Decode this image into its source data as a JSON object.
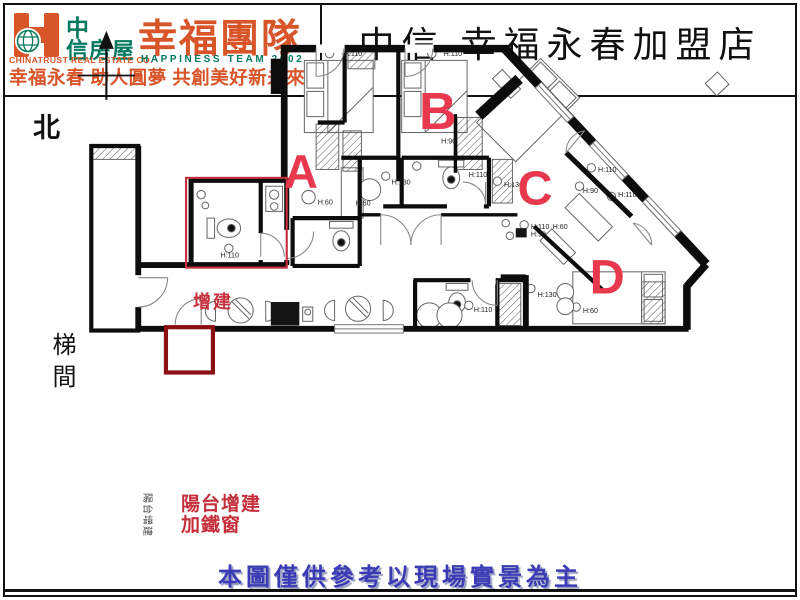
{
  "header": {
    "logo": {
      "cjk_top": "中",
      "cjk_bottom": "信房屋",
      "company_en": "CHINATRUST REAL ESTATE CO."
    },
    "team": {
      "zh": "幸福團隊",
      "en": "HAPPINESS TEAM 2002"
    },
    "tagline": "幸福永春 助人圓夢 共創美好新未來",
    "title": "中信 幸福永春加盟店"
  },
  "plan": {
    "north": "北",
    "stairwell": "梯間",
    "annotations": {
      "addition": "增建",
      "balcony_line1": "陽台增建",
      "balcony_line2": "加鐵窗",
      "balcony_box": "陽台增建"
    },
    "rooms": [
      {
        "label": "A"
      },
      {
        "label": "B"
      },
      {
        "label": "C"
      },
      {
        "label": "D"
      }
    ],
    "height_labels": [
      {
        "text": "H:110"
      },
      {
        "text": "H:110"
      },
      {
        "text": "H:90"
      },
      {
        "text": "H:60"
      },
      {
        "text": "H:60"
      },
      {
        "text": "H:130"
      },
      {
        "text": "H:110"
      },
      {
        "text": "H:130"
      },
      {
        "text": "H:110"
      },
      {
        "text": "H:110"
      },
      {
        "text": "H:60"
      },
      {
        "text": "H:90"
      },
      {
        "text": "H:110"
      },
      {
        "text": "H:90"
      },
      {
        "text": "H:110"
      },
      {
        "text": "H:130"
      },
      {
        "text": "H:60"
      },
      {
        "text": "H:110"
      }
    ]
  },
  "footer": {
    "disclaimer": "本圖僅供參考以現場實景為主"
  },
  "colors": {
    "brand_orange": "#d8552a",
    "brand_teal": "#00795f",
    "room_red": "#e8384e",
    "annotation_red": "#c5303c",
    "balcony_box_red": "#8a1016",
    "disclaimer_blue": "#3b3bb5"
  }
}
